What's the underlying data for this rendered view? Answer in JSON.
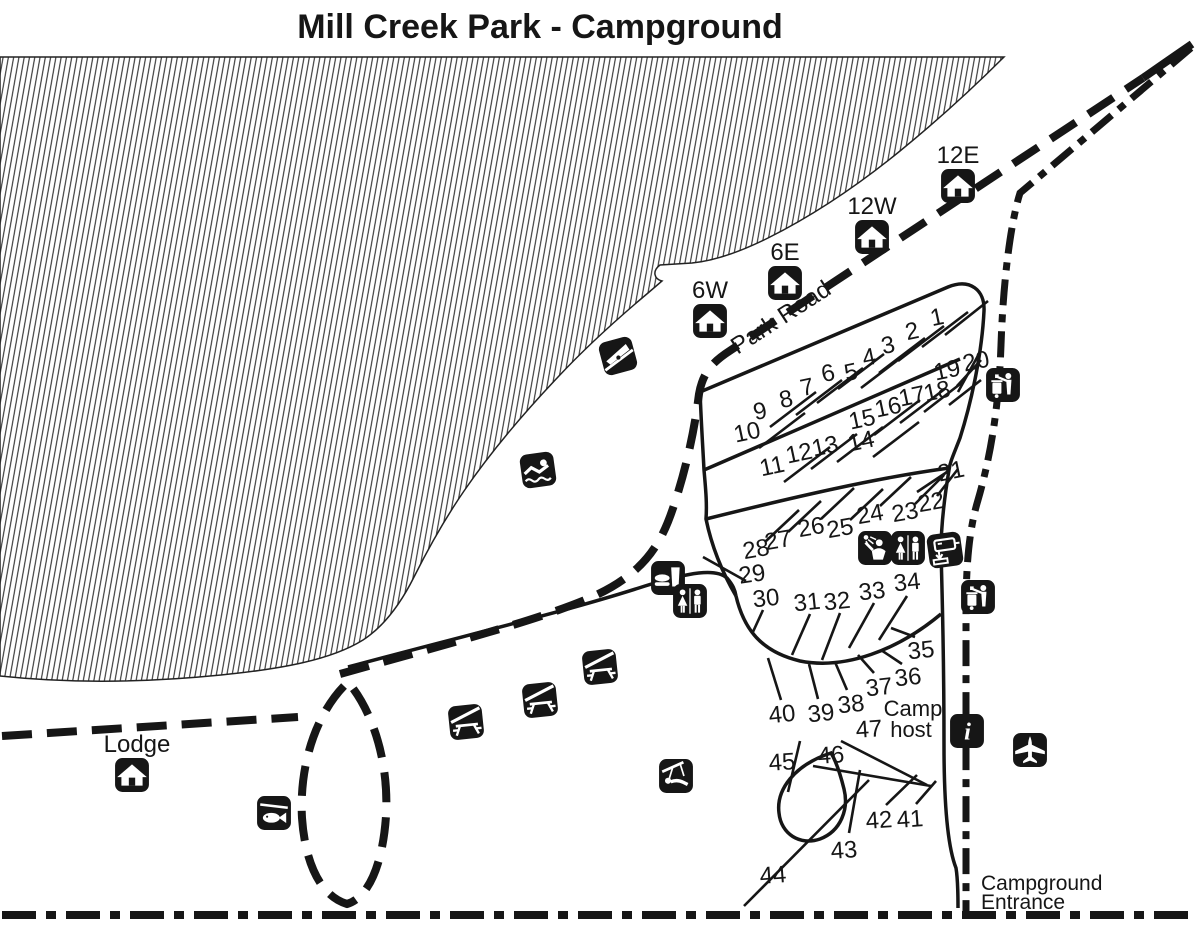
{
  "title": "Mill Creek Park - Campground",
  "map": {
    "ink": "#161616",
    "labels": [
      {
        "id": "park-road",
        "text": "Park Road",
        "x": 785,
        "y": 324,
        "size": 24,
        "rot": -33
      },
      {
        "id": "camp-host-line1",
        "text": "Camp",
        "x": 913,
        "y": 716,
        "size": 22
      },
      {
        "id": "camp-host-line2",
        "text": "host",
        "x": 911,
        "y": 737,
        "size": 22
      },
      {
        "id": "campground-entrance-line1",
        "text": "Campground",
        "x": 981,
        "y": 890,
        "size": 21,
        "anchor": "start"
      },
      {
        "id": "campground-entrance-line2",
        "text": "Entrance",
        "x": 981,
        "y": 909,
        "size": 21,
        "anchor": "start"
      }
    ],
    "icons": [
      {
        "name": "shelter",
        "id": "shelter-12E",
        "x": 958,
        "y": 186,
        "label": "12E",
        "lx": 958,
        "ly": 163
      },
      {
        "name": "shelter",
        "id": "shelter-12W",
        "x": 872,
        "y": 237,
        "label": "12W",
        "lx": 872,
        "ly": 214
      },
      {
        "name": "shelter",
        "id": "shelter-6E",
        "x": 785,
        "y": 283,
        "label": "6E",
        "lx": 785,
        "ly": 260
      },
      {
        "name": "shelter",
        "id": "shelter-6W",
        "x": 710,
        "y": 321,
        "label": "6W",
        "lx": 710,
        "ly": 298
      },
      {
        "name": "boat-ramp",
        "id": "boat-ramp",
        "x": 618,
        "y": 356,
        "rot": -15
      },
      {
        "name": "swimming",
        "id": "swimming-area",
        "x": 538,
        "y": 470,
        "rot": -8
      },
      {
        "name": "food",
        "id": "concessions",
        "x": 668,
        "y": 578
      },
      {
        "name": "restroom",
        "id": "restroom-west",
        "x": 690,
        "y": 601
      },
      {
        "name": "shower",
        "id": "showers",
        "x": 875,
        "y": 548
      },
      {
        "name": "restroom",
        "id": "restroom-east",
        "x": 908,
        "y": 548
      },
      {
        "name": "dump-station",
        "id": "dump-station",
        "x": 945,
        "y": 550,
        "rot": -8
      },
      {
        "name": "trash",
        "id": "trash-north",
        "x": 1003,
        "y": 385
      },
      {
        "name": "trash",
        "id": "trash-south",
        "x": 978,
        "y": 597
      },
      {
        "name": "picnic-shelter",
        "id": "picnic-shelter-1",
        "x": 600,
        "y": 667,
        "rot": -6
      },
      {
        "name": "picnic-shelter",
        "id": "picnic-shelter-2",
        "x": 540,
        "y": 700,
        "rot": -6
      },
      {
        "name": "picnic-shelter",
        "id": "picnic-shelter-3",
        "x": 466,
        "y": 722,
        "rot": -6
      },
      {
        "name": "shelter",
        "id": "lodge",
        "x": 132,
        "y": 775,
        "label": "Lodge",
        "lx": 137,
        "ly": 752
      },
      {
        "name": "fish",
        "id": "fishing",
        "x": 274,
        "y": 813
      },
      {
        "name": "playground",
        "id": "playground",
        "x": 676,
        "y": 776
      },
      {
        "name": "info",
        "id": "information",
        "x": 967,
        "y": 731
      },
      {
        "name": "airplane",
        "id": "airport",
        "x": 1030,
        "y": 750
      }
    ]
  },
  "sites": [
    {
      "n": "1",
      "x": 937,
      "y": 317,
      "rot": -12,
      "spur": [
        945,
        335,
        988,
        301
      ]
    },
    {
      "n": "2",
      "x": 912,
      "y": 331,
      "rot": -12,
      "spur": [
        922,
        347,
        968,
        312
      ]
    },
    {
      "n": "3",
      "x": 888,
      "y": 345,
      "rot": -12,
      "spur": [
        898,
        361,
        944,
        326
      ]
    },
    {
      "n": "4",
      "x": 869,
      "y": 357,
      "rot": -12,
      "spur": [
        879,
        373,
        925,
        338
      ]
    },
    {
      "n": "5",
      "x": 851,
      "y": 372,
      "rot": -12,
      "spur": [
        861,
        388,
        907,
        353
      ]
    },
    {
      "n": "6",
      "x": 828,
      "y": 373,
      "rot": -12,
      "spur": [
        838,
        389,
        884,
        354
      ]
    },
    {
      "n": "7",
      "x": 807,
      "y": 387,
      "rot": -12,
      "spur": [
        817,
        403,
        863,
        368
      ]
    },
    {
      "n": "8",
      "x": 786,
      "y": 399,
      "rot": -12,
      "spur": [
        796,
        415,
        842,
        380
      ]
    },
    {
      "n": "9",
      "x": 760,
      "y": 411,
      "rot": -12,
      "spur": [
        770,
        427,
        816,
        392
      ]
    },
    {
      "n": "10",
      "x": 747,
      "y": 432,
      "rot": -12,
      "spur": [
        759,
        448,
        805,
        413
      ]
    },
    {
      "n": "11",
      "x": 772,
      "y": 466,
      "rot": -12,
      "spur": [
        784,
        482,
        830,
        447
      ]
    },
    {
      "n": "12",
      "x": 799,
      "y": 453,
      "rot": -12,
      "spur": [
        811,
        469,
        857,
        434
      ]
    },
    {
      "n": "13",
      "x": 825,
      "y": 446,
      "rot": -12,
      "spur": [
        837,
        462,
        883,
        427
      ]
    },
    {
      "n": "14",
      "x": 861,
      "y": 441,
      "rot": -12,
      "spur": [
        873,
        457,
        919,
        422
      ]
    },
    {
      "n": "15",
      "x": 862,
      "y": 419,
      "rot": -12,
      "spur": [
        874,
        435,
        920,
        400
      ]
    },
    {
      "n": "16",
      "x": 888,
      "y": 407,
      "rot": -12,
      "spur": [
        900,
        423,
        946,
        388
      ]
    },
    {
      "n": "17",
      "x": 912,
      "y": 396,
      "rot": -12,
      "spur": [
        924,
        412,
        964,
        381
      ]
    },
    {
      "n": "18",
      "x": 937,
      "y": 391,
      "rot": -12,
      "spur": [
        949,
        405,
        981,
        380
      ]
    },
    {
      "n": "19",
      "x": 947,
      "y": 370,
      "rot": -12,
      "spur": [
        957,
        386,
        981,
        360
      ]
    },
    {
      "n": "20",
      "x": 976,
      "y": 361,
      "rot": -12,
      "spur": [
        958,
        392,
        980,
        352
      ]
    },
    {
      "n": "21",
      "x": 951,
      "y": 471,
      "rot": -12,
      "spur": [
        917,
        492,
        947,
        472
      ]
    },
    {
      "n": "22",
      "x": 931,
      "y": 502,
      "rot": -10,
      "spur": [
        937,
        496,
        958,
        469
      ]
    },
    {
      "n": "23",
      "x": 905,
      "y": 512,
      "rot": -10,
      "spur": [
        915,
        504,
        944,
        475
      ]
    },
    {
      "n": "24",
      "x": 870,
      "y": 514,
      "rot": -10,
      "spur": [
        880,
        506,
        911,
        477
      ]
    },
    {
      "n": "25",
      "x": 840,
      "y": 528,
      "rot": -10,
      "spur": [
        850,
        520,
        883,
        489
      ]
    },
    {
      "n": "26",
      "x": 811,
      "y": 527,
      "rot": -10,
      "spur": [
        821,
        519,
        854,
        488
      ]
    },
    {
      "n": "27",
      "x": 778,
      "y": 540,
      "rot": -10,
      "spur": [
        788,
        532,
        821,
        501
      ]
    },
    {
      "n": "28",
      "x": 756,
      "y": 549,
      "rot": -10,
      "spur": [
        766,
        541,
        799,
        510
      ]
    },
    {
      "n": "29",
      "x": 752,
      "y": 574,
      "rot": -8,
      "spur": [
        703,
        557,
        746,
        581
      ]
    },
    {
      "n": "30",
      "x": 766,
      "y": 598,
      "rot": -6,
      "spur": [
        763,
        610,
        752,
        634
      ]
    },
    {
      "n": "31",
      "x": 807,
      "y": 602,
      "rot": -6,
      "spur": [
        810,
        614,
        792,
        655
      ]
    },
    {
      "n": "32",
      "x": 837,
      "y": 601,
      "rot": -6,
      "spur": [
        840,
        613,
        822,
        660
      ]
    },
    {
      "n": "33",
      "x": 872,
      "y": 591,
      "rot": -6,
      "spur": [
        874,
        603,
        849,
        648
      ]
    },
    {
      "n": "34",
      "x": 907,
      "y": 582,
      "rot": -6,
      "spur": [
        907,
        596,
        879,
        640
      ]
    },
    {
      "n": "35",
      "x": 921,
      "y": 650,
      "rot": -6,
      "spur": [
        915,
        637,
        891,
        628
      ]
    },
    {
      "n": "36",
      "x": 908,
      "y": 677,
      "rot": -6,
      "spur": [
        902,
        664,
        881,
        650
      ]
    },
    {
      "n": "37",
      "x": 879,
      "y": 687,
      "rot": -6,
      "spur": [
        874,
        673,
        858,
        655
      ]
    },
    {
      "n": "38",
      "x": 851,
      "y": 704,
      "rot": -6,
      "spur": [
        847,
        690,
        835,
        662
      ]
    },
    {
      "n": "39",
      "x": 821,
      "y": 713,
      "rot": -6,
      "spur": [
        818,
        699,
        809,
        664
      ]
    },
    {
      "n": "40",
      "x": 782,
      "y": 714,
      "rot": -6,
      "spur": [
        781,
        700,
        768,
        658
      ]
    },
    {
      "n": "41",
      "x": 910,
      "y": 819,
      "rot": -4,
      "spur": [
        916,
        804,
        936,
        781
      ]
    },
    {
      "n": "42",
      "x": 879,
      "y": 820,
      "rot": -4,
      "spur": [
        886,
        805,
        917,
        775
      ]
    },
    {
      "n": "43",
      "x": 844,
      "y": 850,
      "rot": -4,
      "spur": [
        849,
        833,
        860,
        770
      ]
    },
    {
      "n": "44",
      "x": 773,
      "y": 875,
      "rot": -4,
      "spur": [
        744,
        906,
        869,
        780
      ]
    },
    {
      "n": "45",
      "x": 782,
      "y": 762,
      "rot": -4,
      "spur": [
        800,
        741,
        788,
        792
      ]
    },
    {
      "n": "46",
      "x": 831,
      "y": 755,
      "rot": -4,
      "spur": [
        813,
        766,
        931,
        786
      ]
    },
    {
      "n": "47",
      "x": 869,
      "y": 729,
      "rot": -4,
      "spur": [
        841,
        741,
        927,
        785
      ]
    }
  ]
}
